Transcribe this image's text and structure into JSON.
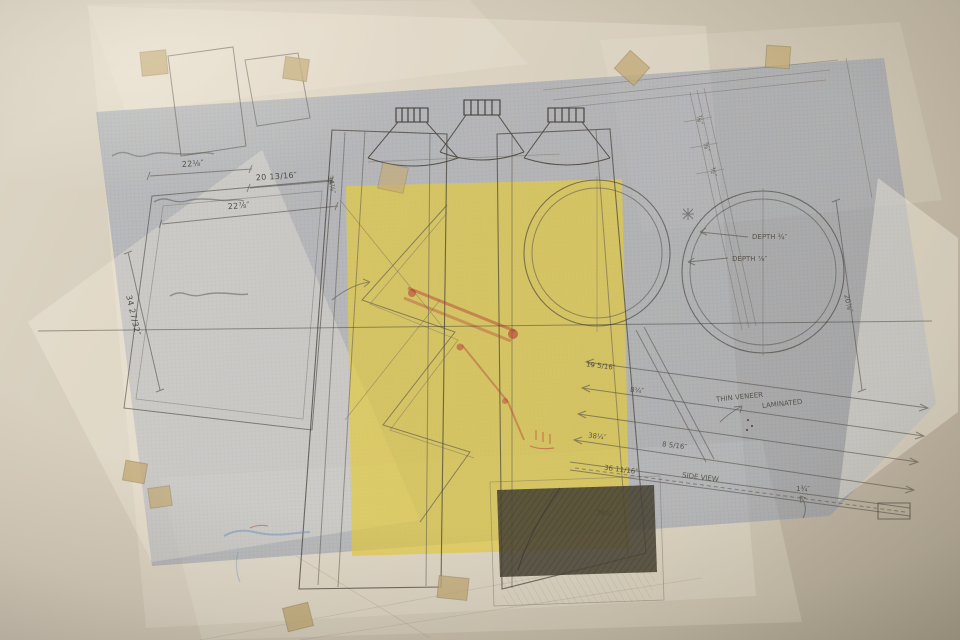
{
  "colors": {
    "wall": "#cfc6b5",
    "sheet_cream": "#f7f1e2",
    "sheet_blue": "#8e99ad",
    "sheet_yellow": "#e3cb41",
    "tape": "#c3ac79",
    "pencil": "#55504a",
    "red_pencil": "#b23a31",
    "blue_ink": "#6e93c0",
    "dark_panel": "#4a4537"
  },
  "annotations": [
    {
      "text": "22⅛″"
    },
    {
      "text": "20 13/16″"
    },
    {
      "text": "22⅞″"
    },
    {
      "text": "34 27/32″"
    },
    {
      "text": "34⅞″"
    },
    {
      "text": "⅞″"
    },
    {
      "text": "⅝″"
    },
    {
      "text": "½″"
    },
    {
      "text": "DEPTH ¾″"
    },
    {
      "text": "DEPTH ⅞″"
    },
    {
      "text": "20⅞″"
    },
    {
      "text": "19 5/16″"
    },
    {
      "text": "8¼″"
    },
    {
      "text": "38¼″"
    },
    {
      "text": "8 5/16″"
    },
    {
      "text": "36 11/16″"
    },
    {
      "text": "SIDE VIEW"
    },
    {
      "text": "1¾″"
    },
    {
      "text": "38⅝″"
    },
    {
      "text": "THIN VENEER"
    },
    {
      "text": "LAMINATED"
    }
  ]
}
